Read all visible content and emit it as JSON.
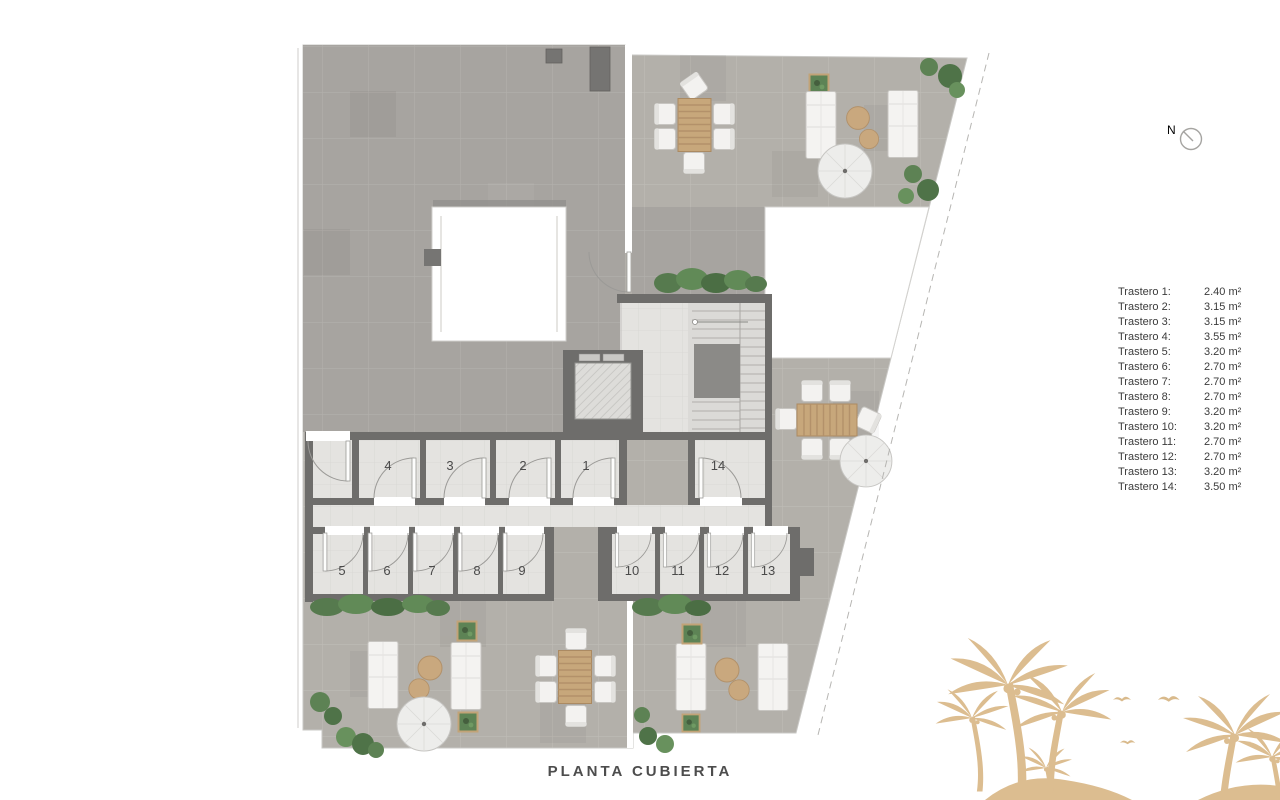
{
  "title": "PLANTA CUBIERTA",
  "compass": {
    "label": "N"
  },
  "legend": {
    "items": [
      {
        "label": "Trastero 1:",
        "value": "2.40 m²"
      },
      {
        "label": "Trastero 2:",
        "value": "3.15 m²"
      },
      {
        "label": "Trastero 3:",
        "value": "3.15 m²"
      },
      {
        "label": "Trastero 4:",
        "value": "3.55 m²"
      },
      {
        "label": "Trastero 5:",
        "value": "3.20 m²"
      },
      {
        "label": "Trastero 6:",
        "value": "2.70 m²"
      },
      {
        "label": "Trastero 7:",
        "value": "2.70 m²"
      },
      {
        "label": "Trastero 8:",
        "value": "2.70 m²"
      },
      {
        "label": "Trastero 9:",
        "value": "3.20 m²"
      },
      {
        "label": "Trastero 10:",
        "value": "3.20 m²"
      },
      {
        "label": "Trastero 11:",
        "value": "2.70 m²"
      },
      {
        "label": "Trastero 12:",
        "value": "2.70 m²"
      },
      {
        "label": "Trastero 13:",
        "value": "3.20 m²"
      },
      {
        "label": "Trastero 14:",
        "value": "3.50 m²"
      }
    ]
  },
  "plan": {
    "rooms": [
      {
        "number": "1"
      },
      {
        "number": "2"
      },
      {
        "number": "3"
      },
      {
        "number": "4"
      },
      {
        "number": "5"
      },
      {
        "number": "6"
      },
      {
        "number": "7"
      },
      {
        "number": "8"
      },
      {
        "number": "9"
      },
      {
        "number": "10"
      },
      {
        "number": "11"
      },
      {
        "number": "12"
      },
      {
        "number": "13"
      },
      {
        "number": "14"
      }
    ]
  },
  "colors": {
    "wall": "#6e6d6b",
    "roof_tile": "#a7a4a0",
    "terrace_tile": "#b3b0aa",
    "floor_tile": "#e4e3e0",
    "plant_green": "#597e50",
    "wood": "#c7a77b",
    "palm_watermark": "#dcbd90"
  }
}
